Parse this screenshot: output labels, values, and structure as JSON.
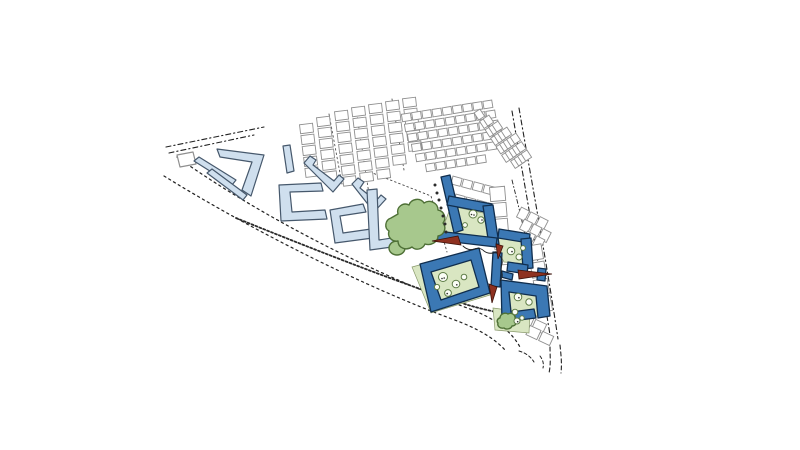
{
  "meta": {
    "type": "architectural-masterplan-site-plan",
    "background": "#ffffff"
  },
  "palette": {
    "road": "#222222",
    "lane": "#555555",
    "house_fill": "#ffffff",
    "house_stroke": "#8f8f8f",
    "pale_fill": "#cfdfee",
    "pale_stroke": "#46586c",
    "green_fill": "#d9e6c2",
    "green_stroke": "#89996b",
    "blue_fill": "#3b78b4",
    "blue_stroke": "#102e4e",
    "tree_fill": "#a7c88d",
    "tree_stroke": "#4e7036",
    "circle_fill": "#fbfdf6",
    "circle_stroke": "#5d7b45",
    "dot": "#2b2b2b",
    "red_fill": "#8e3120",
    "red_stroke": "#3c120a"
  },
  "map": {
    "roads": [
      {
        "name": "road-north-edge-outer",
        "d": "M166,147 L264,127",
        "dash": "5 3 1.2 3",
        "w": 1.1
      },
      {
        "name": "road-north-edge-inner",
        "d": "M169,153 L254,135",
        "dash": "5 3 1.2 3",
        "w": 1.1
      },
      {
        "name": "road-main-upper",
        "d": "M177,157 C270,223 385,278 470,309 C494,318 512,331 521,349",
        "dash": "2.2 3.4",
        "w": 1.2
      },
      {
        "name": "road-main-lower",
        "d": "M164,176 C258,234 368,288 452,319 C477,328 494,338 505,350",
        "dash": "2.2 3.4",
        "w": 1.2
      },
      {
        "name": "roadside-hedge",
        "d": "M236,218 C320,252 410,287 468,305 C492,312 508,314 521,317",
        "dash": "2 2.2",
        "w": 1.8,
        "c": "#2a2a2a"
      },
      {
        "name": "road-east-outer",
        "d": "M512,111 C522,170 538,260 551,341",
        "dash": "5 3 1.2 3",
        "w": 1.1
      },
      {
        "name": "road-east-inner",
        "d": "M519,108 C529,167 546,258 558,339",
        "dash": "5 3 1.2 3",
        "w": 1.1
      },
      {
        "name": "road-south-neck-left",
        "d": "M550,347 C550,356 551,364 549,373",
        "dash": "4 3",
        "w": 1.1
      },
      {
        "name": "road-south-neck-right",
        "d": "M560,345 C561,355 562,363 561,373",
        "dash": "4 3",
        "w": 1.1
      },
      {
        "name": "junction-curb-left",
        "d": "M519,351 C526,353 531,357 534,362",
        "dash": "3 2.5",
        "w": 1
      },
      {
        "name": "junction-curb-mid",
        "d": "M540,356 C543,360 544,364 543,368",
        "dash": "3 2.5",
        "w": 1
      },
      {
        "name": "lane-housing-a1",
        "d": "M329,114 L342,184",
        "dash": "1.6 2.8",
        "w": 0.9,
        "c": "#555555"
      },
      {
        "name": "lane-housing-a2",
        "d": "M356,109 L369,194",
        "dash": "1.6 2.8",
        "w": 0.9,
        "c": "#555555"
      },
      {
        "name": "lane-housing-a3",
        "d": "M392,99 L404,170",
        "dash": "1.6 2.8",
        "w": 0.9,
        "c": "#555555"
      },
      {
        "name": "lane-front-street",
        "d": "M370,172 L431,196 L447,252",
        "dash": "1.6 2.8",
        "w": 0.9,
        "c": "#444444"
      },
      {
        "name": "lane-east-street",
        "d": "M512,180 C517,200 521,216 525,235",
        "dash": "4 2.5 1 2.5",
        "w": 0.9
      }
    ],
    "house_rows": [
      {
        "name": "housing-col-a1",
        "x": 306,
        "y": 124,
        "a": 83,
        "n": 5,
        "L": 9,
        "D": 13,
        "g": 2
      },
      {
        "name": "housing-col-a2",
        "x": 323,
        "y": 117,
        "a": 83,
        "n": 6,
        "L": 9,
        "D": 13,
        "g": 2
      },
      {
        "name": "housing-col-a3",
        "x": 341,
        "y": 111,
        "a": 83,
        "n": 7,
        "L": 9,
        "D": 13,
        "g": 2
      },
      {
        "name": "housing-col-a4",
        "x": 358,
        "y": 107,
        "a": 83,
        "n": 7,
        "L": 9,
        "D": 13,
        "g": 2
      },
      {
        "name": "housing-col-a5",
        "x": 375,
        "y": 104,
        "a": 83,
        "n": 7,
        "L": 9,
        "D": 13,
        "g": 2
      },
      {
        "name": "housing-col-a6",
        "x": 392,
        "y": 101,
        "a": 83,
        "n": 6,
        "L": 9,
        "D": 13,
        "g": 2
      },
      {
        "name": "housing-col-a7",
        "x": 409,
        "y": 98,
        "a": 83,
        "n": 5,
        "L": 9,
        "D": 13,
        "g": 2
      },
      {
        "name": "housing-row-b1",
        "x": 402,
        "y": 118,
        "a": -9,
        "n": 9,
        "L": 9,
        "D": 7.5,
        "g": 1.3
      },
      {
        "name": "housing-row-b2",
        "x": 405,
        "y": 128,
        "a": -9,
        "n": 9,
        "L": 9,
        "D": 7.5,
        "g": 1.3
      },
      {
        "name": "housing-row-b3",
        "x": 408,
        "y": 138,
        "a": -9,
        "n": 9,
        "L": 9,
        "D": 7.5,
        "g": 1.3
      },
      {
        "name": "housing-row-b4",
        "x": 412,
        "y": 148,
        "a": -9,
        "n": 9,
        "L": 9,
        "D": 7.5,
        "g": 1.3
      },
      {
        "name": "housing-row-b5",
        "x": 416,
        "y": 158,
        "a": -9,
        "n": 8,
        "L": 9,
        "D": 7.5,
        "g": 1.3
      },
      {
        "name": "housing-row-b6",
        "x": 426,
        "y": 168,
        "a": -9,
        "n": 6,
        "L": 9,
        "D": 7.5,
        "g": 1.3
      },
      {
        "name": "housing-row-b7",
        "x": 452,
        "y": 180,
        "a": 15,
        "n": 4,
        "L": 9.5,
        "D": 8,
        "g": 1.5
      },
      {
        "name": "housing-row-b8",
        "x": 455,
        "y": 198,
        "a": 15,
        "n": 4,
        "L": 9.5,
        "D": 8,
        "g": 1.5
      },
      {
        "name": "housing-row-b9",
        "x": 458,
        "y": 216,
        "a": 15,
        "n": 3,
        "L": 9.5,
        "D": 8,
        "g": 1.5
      },
      {
        "name": "housing-strip-c0",
        "x": 477,
        "y": 111,
        "a": 57,
        "n": 6,
        "L": 8.5,
        "D": 7,
        "g": 1.6
      },
      {
        "name": "housing-strip-c1",
        "x": 486,
        "y": 117,
        "a": 57,
        "n": 6,
        "L": 8.5,
        "D": 7,
        "g": 1.6
      },
      {
        "name": "housing-strip-c2",
        "x": 495,
        "y": 123,
        "a": 57,
        "n": 5,
        "L": 8.5,
        "D": 7,
        "g": 1.6
      },
      {
        "name": "housing-strip-c3",
        "x": 504,
        "y": 129,
        "a": 57,
        "n": 4,
        "L": 8.5,
        "D": 7,
        "g": 1.6
      },
      {
        "name": "housing-strip-c4",
        "x": 513,
        "y": 135,
        "a": 57,
        "n": 3,
        "L": 8.5,
        "D": 7,
        "g": 1.6
      },
      {
        "name": "housing-garages-east",
        "x": 497,
        "y": 187,
        "a": 85,
        "n": 5,
        "L": 14,
        "D": 15,
        "g": 2
      },
      {
        "name": "housing-row-d1",
        "x": 519,
        "y": 212,
        "a": 27,
        "n": 3,
        "L": 9,
        "D": 11,
        "g": 1.5
      },
      {
        "name": "housing-row-d2",
        "x": 522,
        "y": 224,
        "a": 27,
        "n": 3,
        "L": 9,
        "D": 11,
        "g": 1.5
      },
      {
        "name": "housing-row-d3",
        "x": 525,
        "y": 236,
        "a": 27,
        "n": 2,
        "L": 9,
        "D": 11,
        "g": 1.5
      },
      {
        "name": "housing-col-e1",
        "x": 534,
        "y": 245,
        "a": 80,
        "n": 4,
        "L": 15,
        "D": 14,
        "g": 2.5
      },
      {
        "name": "housing-row-f1",
        "x": 521,
        "y": 318,
        "a": 25,
        "n": 2,
        "L": 12,
        "D": 10,
        "g": 2
      },
      {
        "name": "housing-row-f2",
        "x": 528,
        "y": 330,
        "a": 25,
        "n": 2,
        "L": 12,
        "D": 10,
        "g": 2
      }
    ],
    "pale_blocks": [
      {
        "name": "outline-parallelogram-west",
        "d": "M177,155 L193,152 L196,164 L180,167 Z",
        "white": true
      },
      {
        "name": "pale-slab-west-a",
        "d": "M194,161 L199,157 L236,180 L232,185 Z"
      },
      {
        "name": "pale-slab-west-b",
        "d": "M207,173 L212,169 L247,195 L243,200 Z"
      },
      {
        "name": "pale-chevron-block",
        "d": "M217,149 L264,155 L251,196 L242,190 L252,162 L220,157 Z"
      },
      {
        "name": "pale-vertical-slab",
        "d": "M283,146 L290,145 L294,171 L287,173 Z"
      },
      {
        "name": "pale-zigzag-block-a",
        "d": "M304,163 L310,156 L316,160 L313,165 L334,181 L339,175 L344,179 L333,192 Z"
      },
      {
        "name": "pale-u-block-a",
        "d": "M279,185 L321,183 L323,191 L290,192 L292,212 L325,210 L327,219 L281,221 Z"
      },
      {
        "name": "pale-zigzag-block-b",
        "d": "M352,184 L358,178 L364,182 L360,188 L376,201 L381,195 L386,199 L374,212 Z"
      },
      {
        "name": "pale-u-block-b",
        "d": "M330,210 L363,204 L366,212 L340,216 L343,233 L371,229 L373,238 L335,243 Z"
      },
      {
        "name": "pale-u-block-c",
        "d": "M367,190 L377,189 L379,240 L404,236 L402,216 L411,214 L414,244 L370,250 Z"
      }
    ],
    "greens": [
      {
        "name": "courtyard-green-a",
        "pts": "451,206 488,214 493,240 441,233"
      },
      {
        "name": "courtyard-green-b",
        "pts": "412,267 478,249 490,295 431,313"
      },
      {
        "name": "courtyard-green-c",
        "pts": "499,234 528,239 530,264 504,262 496,246"
      },
      {
        "name": "courtyard-green-d",
        "pts": "501,282 546,288 549,315 504,319"
      },
      {
        "name": "green-apron-south",
        "pts": "493,308 530,313 529,333 495,330"
      }
    ],
    "new_blocks": [
      {
        "name": "new-slab-street",
        "d": "M441,177 L450,175 L463,230 L454,233 Z"
      },
      {
        "name": "new-block-a-north",
        "d": "M449,196 L492,204 L490,213 L447,205 Z"
      },
      {
        "name": "new-block-a-east",
        "d": "M483,206 L493,205 L499,244 L489,245 Z"
      },
      {
        "name": "new-block-a-south",
        "d": "M437,231 L497,238 L496,247 L436,240 Z"
      },
      {
        "name": "new-block-b-ring",
        "d": "M420,264 L479,248 L490,293 L431,312 Z M431,272 L471,260 L479,287 L441,300 Z",
        "evenodd": true
      },
      {
        "name": "new-block-c-north",
        "d": "M499,229 L530,234 L529,243 L498,238 Z"
      },
      {
        "name": "new-block-c-east",
        "d": "M521,239 L531,238 L533,268 L523,269 Z"
      },
      {
        "name": "new-block-c-hook",
        "d": "M508,262 L528,265 L527,274 L507,271 Z"
      },
      {
        "name": "new-slab-mid",
        "d": "M493,252 L502,253 L500,287 L491,286 Z"
      },
      {
        "name": "new-connector",
        "d": "M502,271 L513,274 L512,280 L501,277 Z"
      },
      {
        "name": "new-block-d-ring",
        "d": "M501,280 L547,286 L550,316 L538,318 L536,296 L509,292 L511,312 L534,309 L536,318 L502,322 Z"
      },
      {
        "name": "new-block-d-stub",
        "d": "M538,268 L546,269 L545,281 L537,280 Z"
      }
    ],
    "street_dots": [
      [
        435,
        185
      ],
      [
        437,
        193
      ],
      [
        439,
        200
      ],
      [
        441,
        208
      ],
      [
        443,
        216
      ],
      [
        445,
        224
      ],
      [
        446,
        232
      ],
      [
        448,
        240
      ]
    ],
    "court_trees": [
      {
        "cx": 473,
        "cy": 214,
        "r": 4,
        "dots": [
          [
            1,
            1
          ],
          [
            -1.5,
            0.5
          ]
        ]
      },
      {
        "cx": 481,
        "cy": 220,
        "r": 3.2,
        "dots": [
          [
            1,
            0
          ]
        ]
      },
      {
        "cx": 465,
        "cy": 225,
        "r": 2.4,
        "dots": []
      },
      {
        "cx": 443,
        "cy": 277,
        "r": 4.5,
        "dots": [
          [
            1.2,
            1
          ],
          [
            -1,
            1.5
          ]
        ]
      },
      {
        "cx": 456,
        "cy": 284,
        "r": 3.8,
        "dots": [
          [
            0.8,
            0.8
          ]
        ]
      },
      {
        "cx": 464,
        "cy": 277,
        "r": 2.8,
        "dots": []
      },
      {
        "cx": 448,
        "cy": 293,
        "r": 3.4,
        "dots": [
          [
            -0.8,
            0.6
          ]
        ]
      },
      {
        "cx": 437,
        "cy": 287,
        "r": 2.6,
        "dots": []
      },
      {
        "cx": 511,
        "cy": 251,
        "r": 3.8,
        "dots": [
          [
            1,
            0.6
          ]
        ]
      },
      {
        "cx": 519,
        "cy": 257,
        "r": 3,
        "dots": []
      },
      {
        "cx": 523,
        "cy": 248,
        "r": 2.4,
        "dots": []
      },
      {
        "cx": 518,
        "cy": 297,
        "r": 3.8,
        "dots": [
          [
            0.9,
            0.7
          ]
        ]
      },
      {
        "cx": 529,
        "cy": 302,
        "r": 3.2,
        "dots": []
      },
      {
        "cx": 515,
        "cy": 312,
        "r": 2.8,
        "dots": []
      },
      {
        "cx": 517,
        "cy": 321,
        "r": 3,
        "dots": [
          [
            0.7,
            0.7
          ]
        ]
      },
      {
        "cx": 522,
        "cy": 318,
        "r": 2.2,
        "dots": []
      }
    ],
    "red_markers": [
      {
        "name": "red-accent-tree-entry",
        "pts": "458,236 461,245 432,241"
      },
      {
        "name": "red-accent-gap-north",
        "pts": "496,244 503,246 498,259"
      },
      {
        "name": "red-accent-gap-south",
        "pts": "489,284 497,287 492,303"
      },
      {
        "name": "red-accent-long-east",
        "pts": "518,270 552,274 519,279"
      }
    ],
    "stream": {
      "name": "stream-line",
      "d": "M463,246 q5,5 11,3 q6,-2 10,2 q4,3 9,2 q5,-1 7,3 q3,4 2,8 q-2,5 0,9 q1,4 -2,8"
    },
    "park_trees": [
      {
        "name": "park-tree-lobe",
        "kind": "ellipse",
        "cx": 397,
        "cy": 248,
        "rx": 8,
        "ry": 7
      },
      {
        "name": "park-tree-main",
        "kind": "path",
        "d": "M398,214 c-2,-7 5,-12 11,-9 c2,-6 11,-8 15,-2 c6,-4 14,0 14,7 c6,1 9,8 5,13 c4,5 1,12 -5,13 c0,6 -7,10 -13,8 c-2,5 -9,7 -13,3 c-6,4 -14,1 -14,-6 c-6,1 -11,-4 -9,-10 c-5,-3 -4,-11 2,-13 z"
      },
      {
        "name": "garden-tree-small",
        "kind": "path",
        "d": "M500,318 c0,-4 5,-6 8,-4 c4,-2 8,1 7,5 c3,2 1,7 -3,7 c-1,3 -6,4 -8,2 c-4,1 -7,-2 -6,-5 c-2,-2 0,-5 2,-5 z"
      }
    ]
  }
}
